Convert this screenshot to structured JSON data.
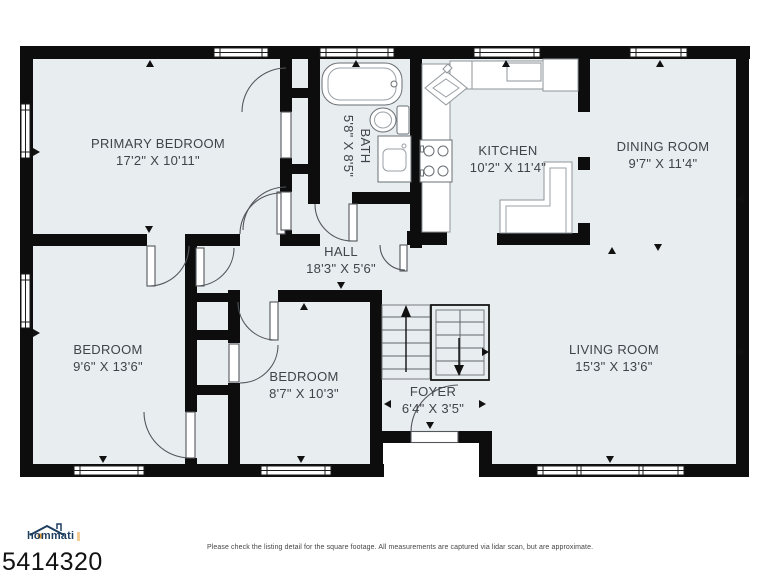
{
  "branding": {
    "logo_text": "hommati",
    "listing_id": "5414320"
  },
  "disclaimer": "Please check the listing detail for the square footage. All measurements are captured via lidar scan, but are approximate.",
  "rooms": [
    {
      "name": "PRIMARY BEDROOM",
      "dims": "17'2\" X 10'11\""
    },
    {
      "name": "BATH",
      "dims": "5'8\" X 8'5\""
    },
    {
      "name": "KITCHEN",
      "dims": "10'2\" X 11'4\""
    },
    {
      "name": "DINING ROOM",
      "dims": "9'7\" X 11'4\""
    },
    {
      "name": "HALL",
      "dims": "18'3\" X 5'6\""
    },
    {
      "name": "BEDROOM",
      "dims": "9'6\" X 13'6\""
    },
    {
      "name": "BEDROOM",
      "dims": "8'7\" X 10'3\""
    },
    {
      "name": "FOYER",
      "dims": "6'4\" X 3'5\""
    },
    {
      "name": "LIVING ROOM",
      "dims": "15'3\" X 13'6\""
    }
  ],
  "colors": {
    "wall": "#0d0d0d",
    "floor": "#e8edf0",
    "fixture_stroke": "#6a6f74",
    "label_text": "#3f444a",
    "logo_navy": "#1e3e5f",
    "logo_orange": "#e8a33d"
  }
}
